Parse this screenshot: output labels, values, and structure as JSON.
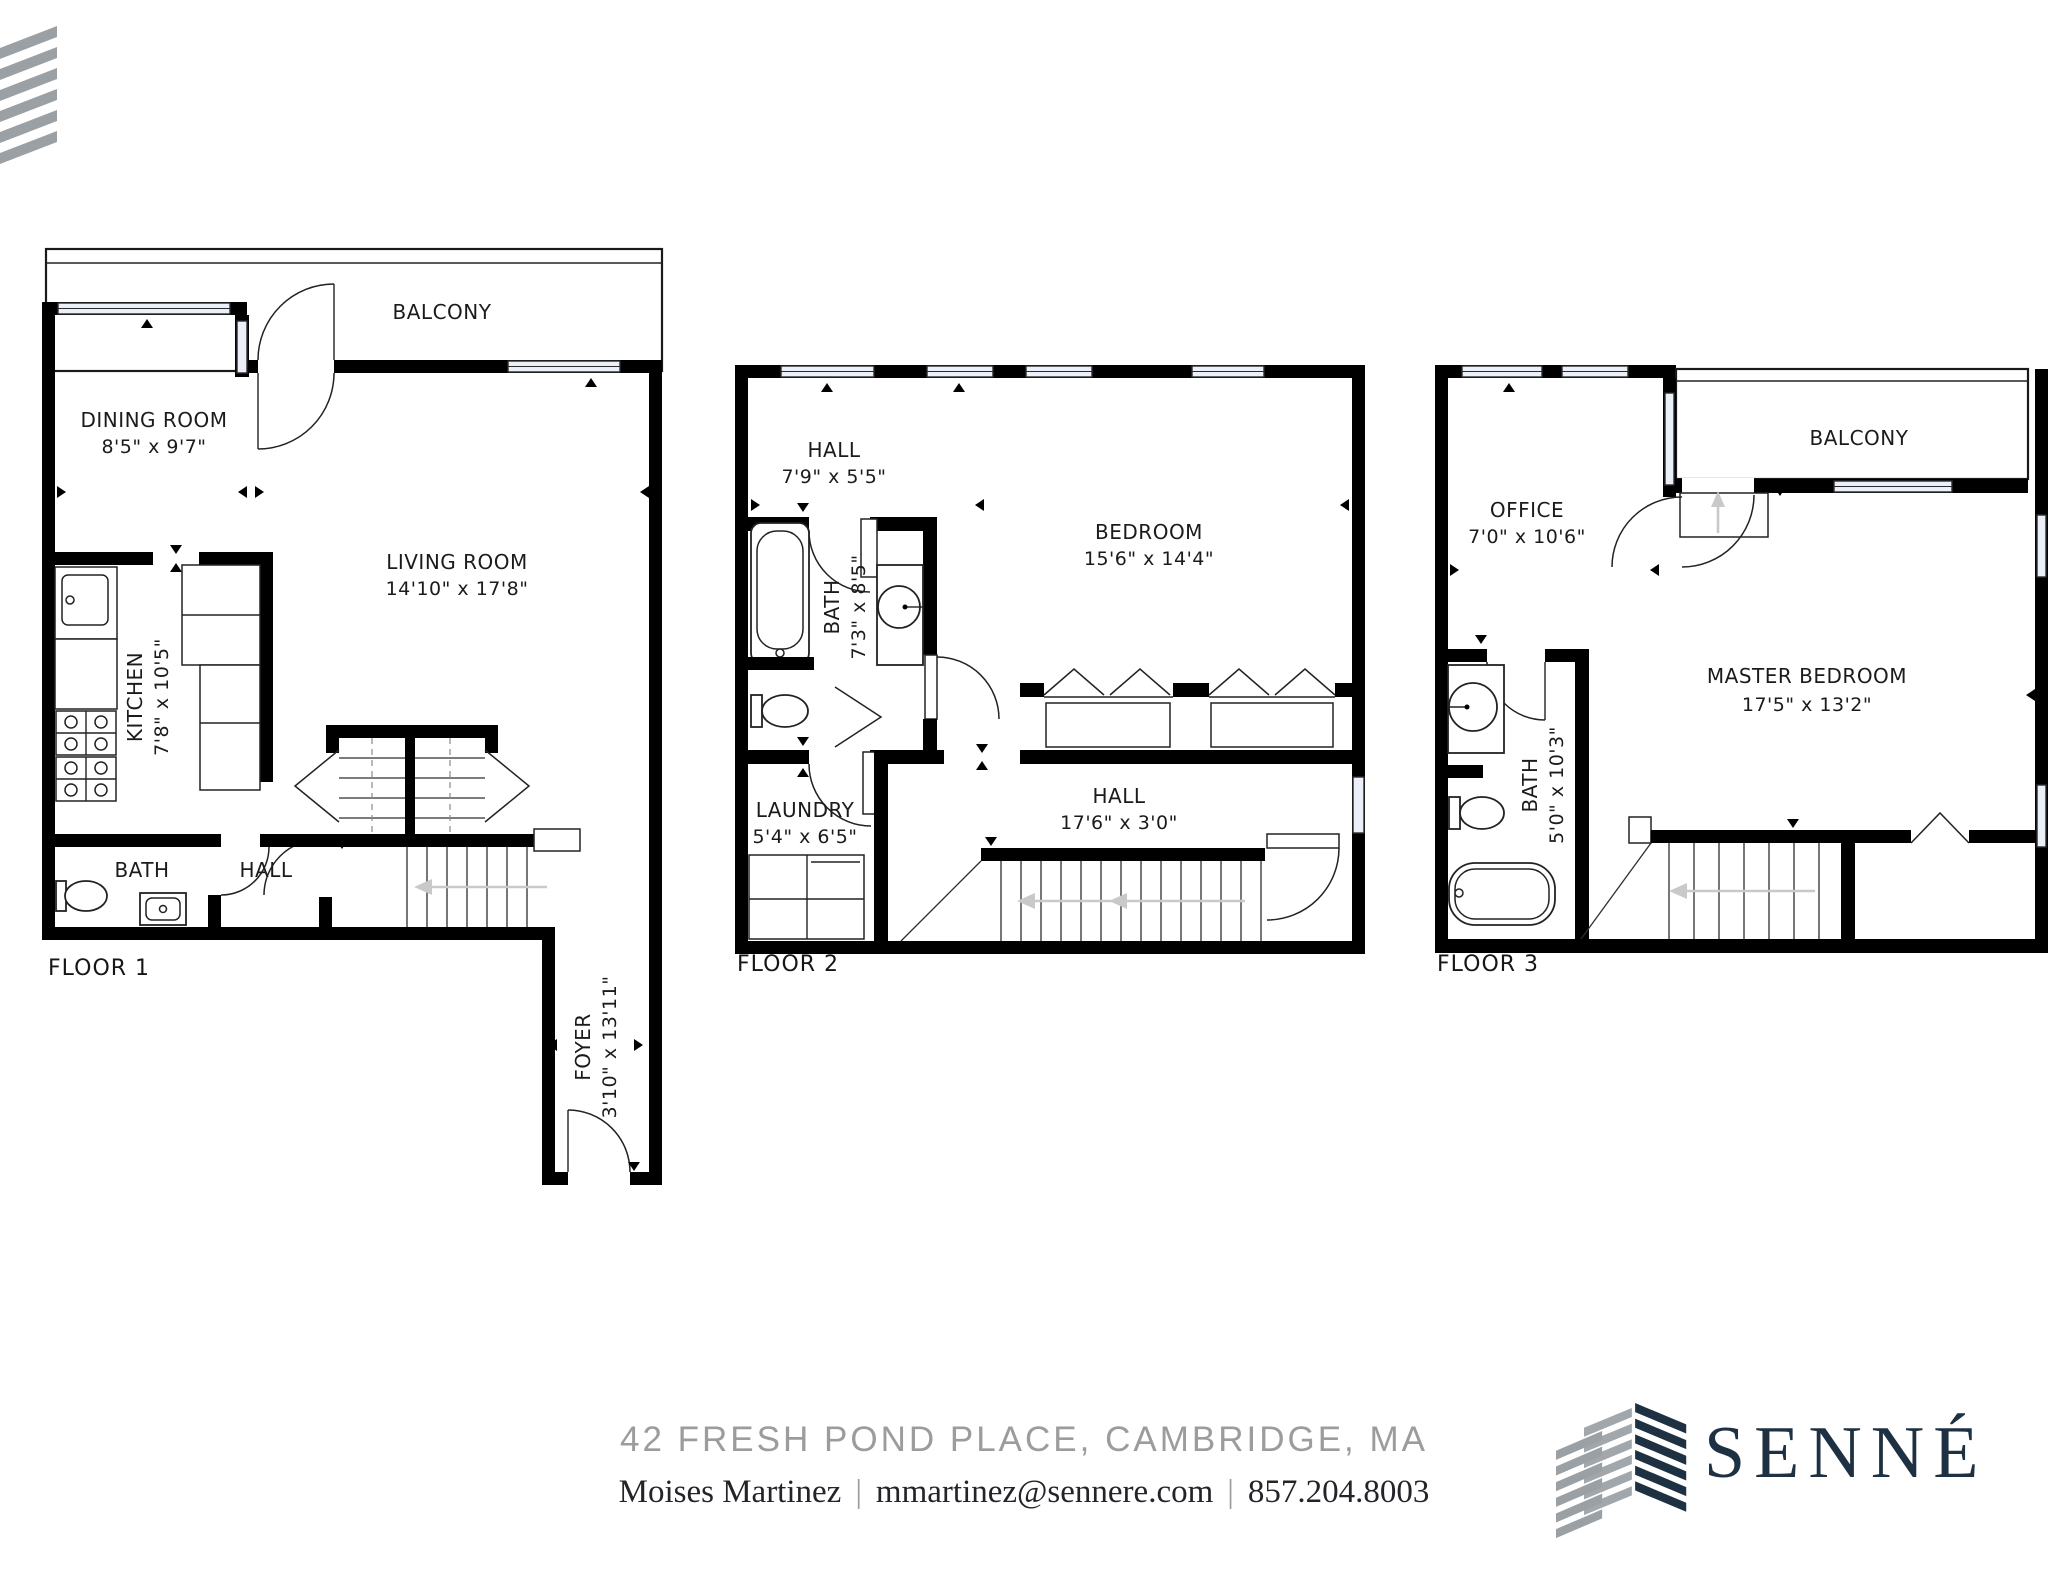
{
  "brand": {
    "wordmark": "SENNÉ",
    "mark_icon": "senne-building-stripes-mark",
    "corner_icon": "diagonal-stripes-mark",
    "colors": {
      "navy": "#1e3143",
      "gray": "#9aa0a3",
      "address_gray": "#9c9c9c",
      "wall": "#000000",
      "window_fill": "#eaeff8"
    }
  },
  "footer": {
    "address": "42 FRESH POND PLACE, CAMBRIDGE, MA",
    "agent_name": "Moises Martinez",
    "agent_email": "mmartinez@sennere.com",
    "agent_phone": "857.204.8003",
    "separator": "|"
  },
  "floors": [
    {
      "label": "FLOOR 1",
      "rooms": [
        {
          "name": "BALCONY",
          "dims": ""
        },
        {
          "name": "DINING ROOM",
          "dims": "8'5\" x 9'7\""
        },
        {
          "name": "LIVING ROOM",
          "dims": "14'10\" x 17'8\""
        },
        {
          "name": "KITCHEN",
          "dims": "7'8\" x 10'5\""
        },
        {
          "name": "BATH",
          "dims": ""
        },
        {
          "name": "HALL",
          "dims": ""
        },
        {
          "name": "FOYER",
          "dims": "3'10\" x 13'11\""
        }
      ]
    },
    {
      "label": "FLOOR 2",
      "rooms": [
        {
          "name": "HALL",
          "dims": "7'9\" x 5'5\""
        },
        {
          "name": "BEDROOM",
          "dims": "15'6\" x 14'4\""
        },
        {
          "name": "BATH",
          "dims": "7'3\" x 8'5\""
        },
        {
          "name": "LAUNDRY",
          "dims": "5'4\" x 6'5\""
        },
        {
          "name": "HALL",
          "dims": "17'6\" x 3'0\""
        }
      ]
    },
    {
      "label": "FLOOR 3",
      "rooms": [
        {
          "name": "OFFICE",
          "dims": "7'0\" x 10'6\""
        },
        {
          "name": "BALCONY",
          "dims": ""
        },
        {
          "name": "MASTER BEDROOM",
          "dims": "17'5\" x 13'2\""
        },
        {
          "name": "BATH",
          "dims": "5'0\" x 10'3\""
        }
      ]
    }
  ]
}
